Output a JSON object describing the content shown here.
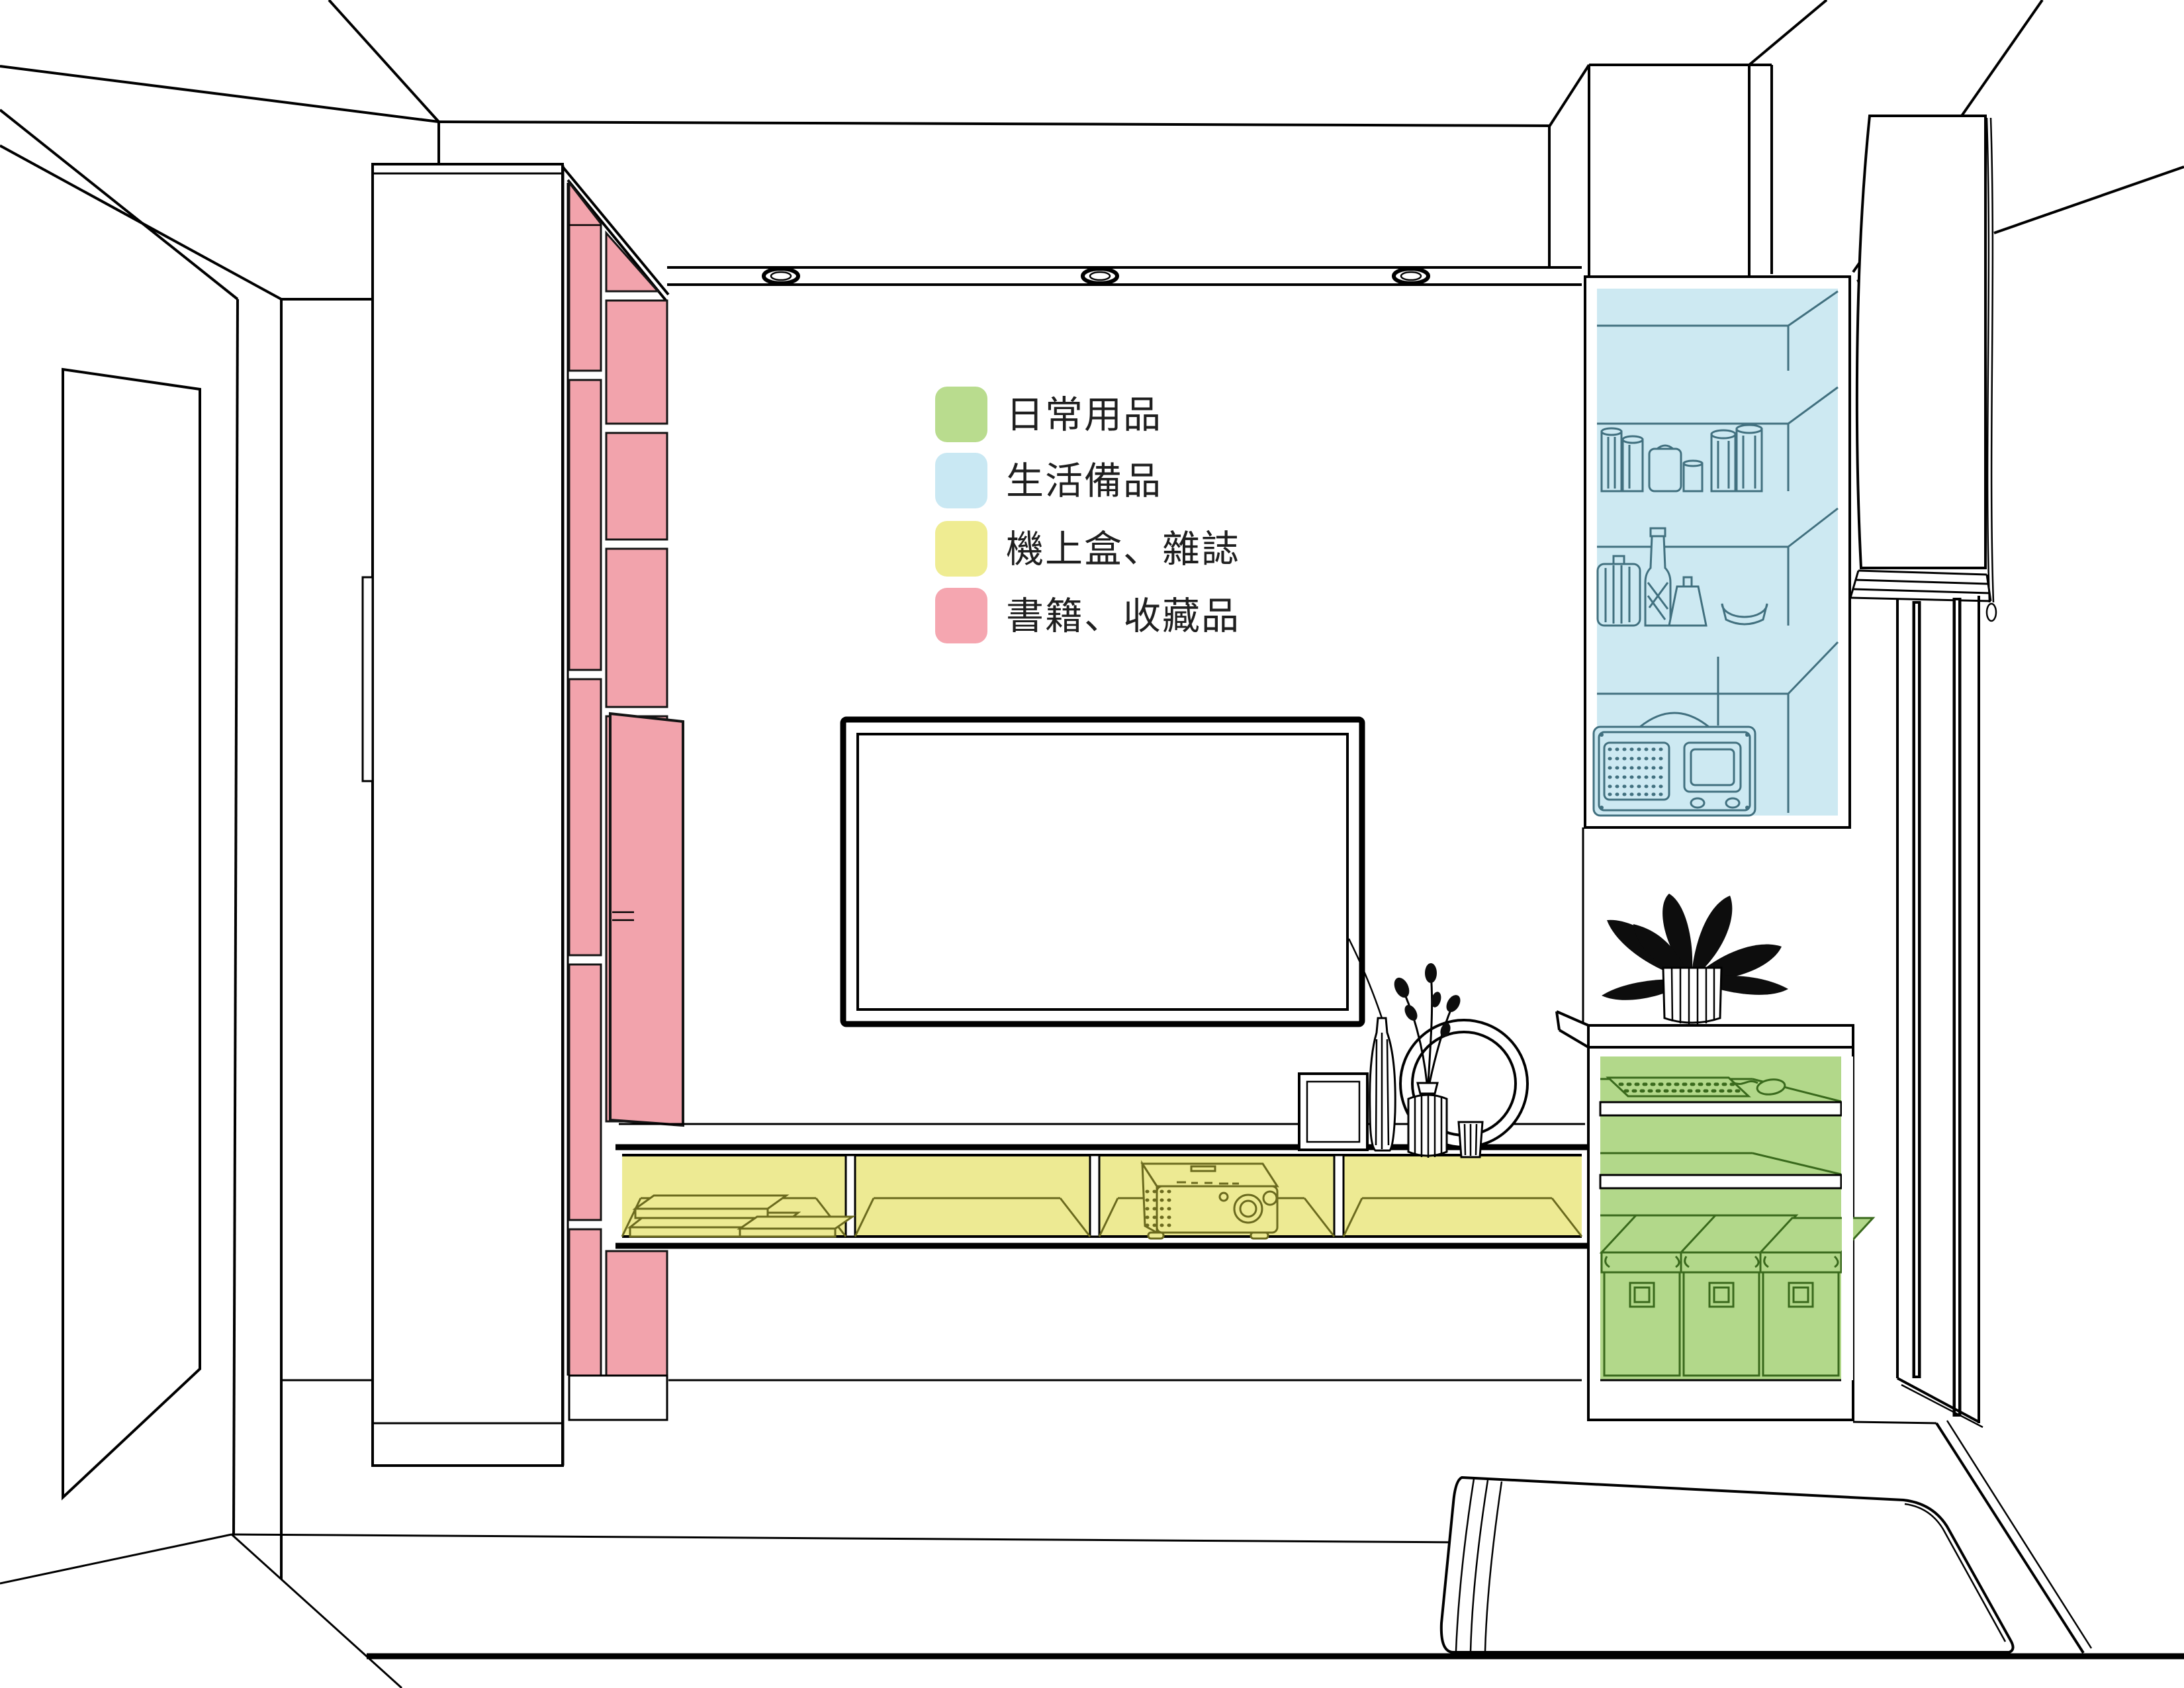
{
  "page": {
    "background": "#ffffff",
    "drawing_type": "interior-storage-plan-perspective"
  },
  "legend": {
    "items": [
      {
        "id": "daily-items",
        "label": "日常用品",
        "color": "#b9dc8e"
      },
      {
        "id": "life-supplies",
        "label": "生活備品",
        "color": "#c9e8f3"
      },
      {
        "id": "settop-mags",
        "label": "機上盒、雜誌",
        "color": "#efec92"
      },
      {
        "id": "books-collect",
        "label": "書籍、收藏品",
        "color": "#f5a6b0"
      }
    ]
  },
  "zones": {
    "green": {
      "fill": "#b2d88a",
      "line": "#39691c"
    },
    "blue": {
      "fill": "#cde9f2",
      "line": "#41707f"
    },
    "yellow": {
      "fill": "#edea93",
      "line": "#6b6a1e"
    },
    "pink": {
      "fill": "#f2a3ac",
      "line": "#141414"
    }
  },
  "lineart": {
    "color": "#000000"
  }
}
